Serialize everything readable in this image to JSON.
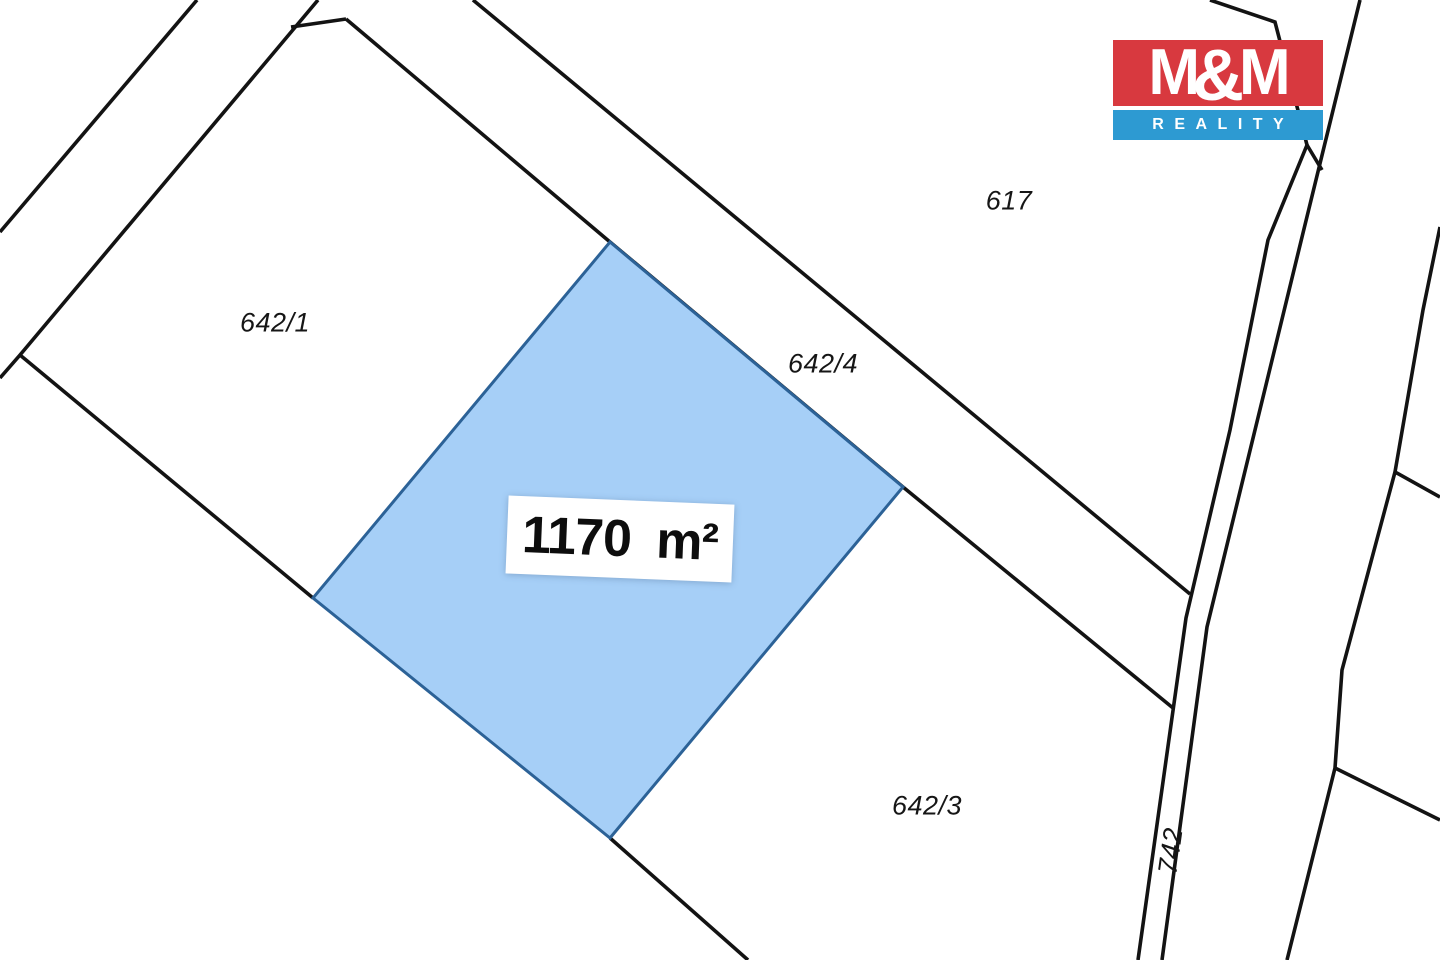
{
  "page": {
    "width": 1440,
    "height": 960,
    "background": "#ffffff"
  },
  "map": {
    "line_color": "#131313",
    "line_width": 3.6,
    "boundaries": [
      {
        "name": "upper-left-road-line",
        "points": [
          [
            197,
            0
          ],
          [
            0,
            232
          ]
        ]
      },
      {
        "name": "parcel-642-1-west-boundary",
        "points": [
          [
            318,
            0
          ],
          [
            20,
            355
          ],
          [
            0,
            378
          ]
        ]
      },
      {
        "name": "top-connector",
        "points": [
          [
            291,
            27
          ],
          [
            346,
            19
          ]
        ]
      },
      {
        "name": "road-strip-southwest-line",
        "points": [
          [
            346,
            19
          ],
          [
            610,
            242
          ],
          [
            903,
            487
          ],
          [
            1173,
            708
          ]
        ]
      },
      {
        "name": "road-strip-northeast-line",
        "points": [
          [
            473,
            0
          ],
          [
            1190,
            594
          ]
        ]
      },
      {
        "name": "parcel-642-1-south-boundary",
        "points": [
          [
            20,
            355
          ],
          [
            313,
            598
          ]
        ]
      },
      {
        "name": "parcel-642-3-west-boundary",
        "points": [
          [
            610,
            838
          ],
          [
            748,
            960
          ]
        ]
      },
      {
        "name": "road-742-west-line",
        "points": [
          [
            1210,
            0
          ],
          [
            1275,
            22
          ],
          [
            1307,
            145
          ],
          [
            1268,
            240
          ],
          [
            1230,
            430
          ],
          [
            1186,
            618
          ],
          [
            1138,
            960
          ]
        ]
      },
      {
        "name": "road-742-east-line",
        "points": [
          [
            1360,
            0
          ],
          [
            1303,
            233
          ],
          [
            1207,
            627
          ],
          [
            1162,
            960
          ]
        ]
      },
      {
        "name": "road-742-top-connector",
        "points": [
          [
            1307,
            145
          ],
          [
            1322,
            170
          ]
        ]
      },
      {
        "name": "east-parcel-boundary",
        "points": [
          [
            1440,
            227
          ],
          [
            1423,
            310
          ],
          [
            1395,
            472
          ],
          [
            1342,
            670
          ],
          [
            1335,
            768
          ],
          [
            1287,
            960
          ]
        ]
      },
      {
        "name": "east-branch-upper",
        "points": [
          [
            1395,
            472
          ],
          [
            1440,
            497
          ]
        ]
      },
      {
        "name": "east-branch-lower",
        "points": [
          [
            1335,
            768
          ],
          [
            1440,
            820
          ]
        ]
      }
    ],
    "highlight": {
      "fill": "#a6cff7",
      "stroke": "#2c6297",
      "stroke_width": 3,
      "polygon": [
        [
          610,
          242
        ],
        [
          903,
          487
        ],
        [
          610,
          838
        ],
        [
          313,
          598
        ]
      ],
      "area_label": {
        "text": "1170 m²",
        "x": 620,
        "y": 539,
        "w": 226,
        "h": 78,
        "rot": 2.3
      }
    },
    "parcel_labels": [
      {
        "text": "642/1",
        "x": 275,
        "y": 323,
        "rot": 0
      },
      {
        "text": "642/4",
        "x": 823,
        "y": 364,
        "rot": 0
      },
      {
        "text": "617",
        "x": 1009,
        "y": 201,
        "rot": 0
      },
      {
        "text": "642/3",
        "x": 927,
        "y": 806,
        "rot": 0
      },
      {
        "text": "742",
        "x": 1171,
        "y": 851,
        "rot": -82
      }
    ]
  },
  "logo": {
    "m_left": "M",
    "amp": "&",
    "m_right": "M",
    "subtitle": "REALITY",
    "red": "#d8393f",
    "blue": "#2d9ad2"
  }
}
